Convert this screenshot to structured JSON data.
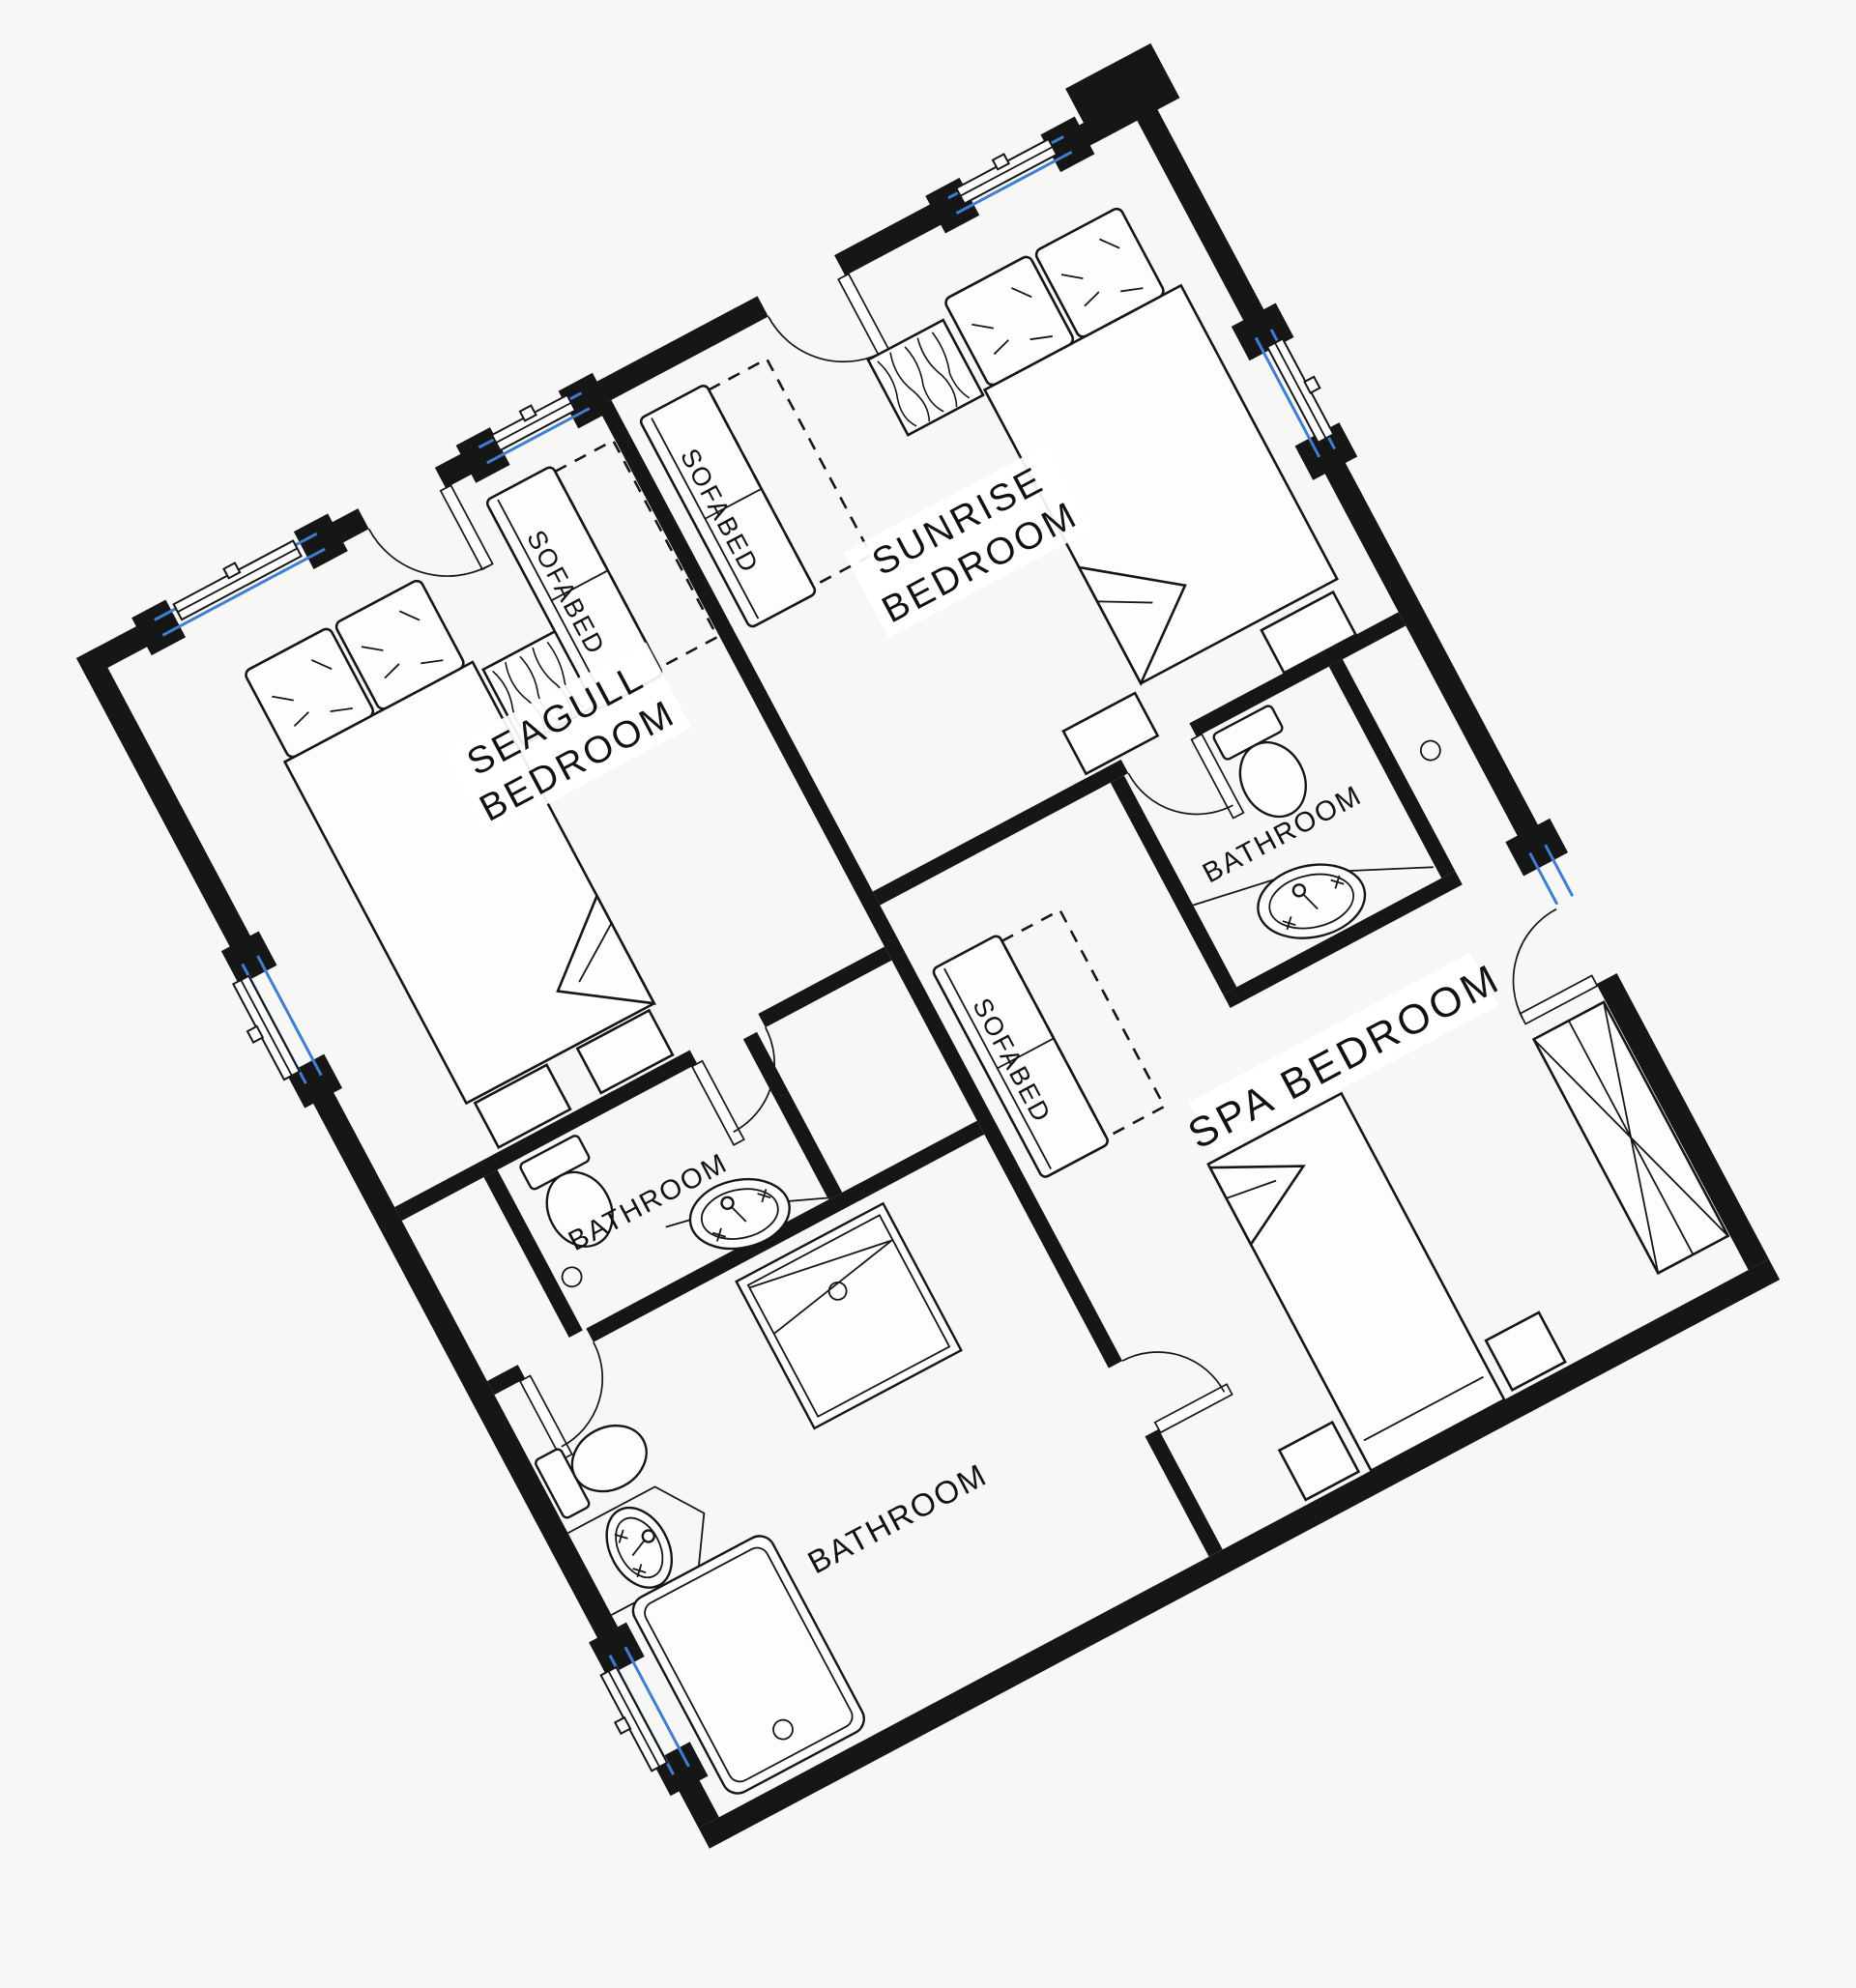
{
  "plan": {
    "type": "floor-plan",
    "rotation_deg": -28,
    "rooms": {
      "seagull": {
        "line1": "SEAGULL",
        "line2": "BEDROOM"
      },
      "sunrise": {
        "line1": "SUNRISE",
        "line2": "BEDROOM"
      },
      "spa": {
        "label": "SPA  BEDROOM"
      },
      "bathroom_sunrise": {
        "label": "BATHROOM"
      },
      "bathroom_seagull": {
        "label": "BATHROOM"
      },
      "bathroom_main": {
        "label": "BATHROOM"
      }
    },
    "furniture": {
      "sofabed_seagull": "SOFABED",
      "sofabed_sunrise": "SOFABED",
      "sofabed_spa": "SOFABED"
    },
    "colors": {
      "wall": "#161616",
      "window": "#3e7ed2",
      "background": "#f7f7f6",
      "paper": "#ffffff"
    }
  }
}
